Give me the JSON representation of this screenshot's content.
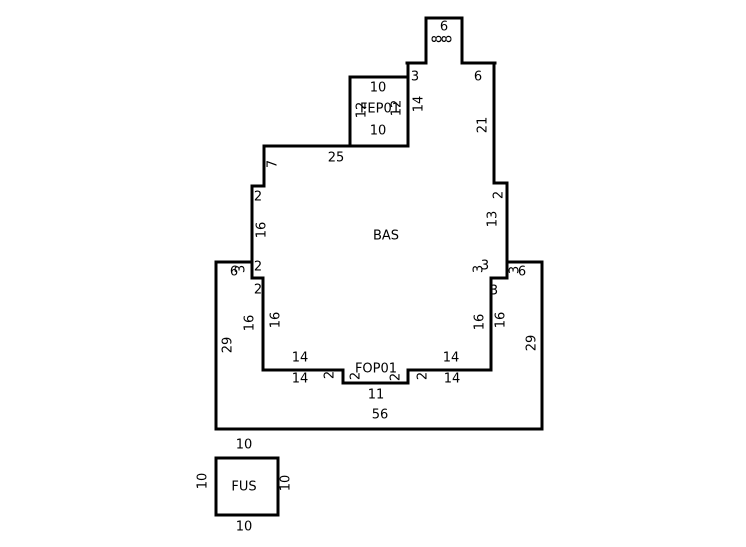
{
  "sketch": {
    "canvas": {
      "width": 746,
      "height": 547,
      "background": "#ffffff",
      "line_color": "#000000"
    },
    "areas": [
      {
        "name": "BAS"
      },
      {
        "name": "FEP01"
      },
      {
        "name": "FOP01"
      },
      {
        "name": "FUS"
      }
    ],
    "outline": {
      "stroke_width": 3,
      "paths": [
        {
          "name": "top-bump",
          "closed": false,
          "points": [
            [
              407,
              63
            ],
            [
              426,
              63
            ],
            [
              426,
              18
            ],
            [
              462,
              18
            ],
            [
              462,
              63
            ],
            [
              495,
              63
            ]
          ]
        },
        {
          "name": "right-upper-wall",
          "closed": false,
          "points": [
            [
              494,
              63
            ],
            [
              494,
              183
            ],
            [
              507,
              183
            ],
            [
              507,
              278
            ],
            [
              491,
              278
            ],
            [
              491,
              370
            ]
          ]
        },
        {
          "name": "bas-bottom-with-porch-notch",
          "closed": false,
          "points": [
            [
              491,
              370
            ],
            [
              408,
              370
            ],
            [
              408,
              383
            ],
            [
              343,
              383
            ],
            [
              343,
              370
            ],
            [
              263,
              370
            ]
          ]
        },
        {
          "name": "left-wall",
          "closed": false,
          "points": [
            [
              263,
              370
            ],
            [
              263,
              278
            ],
            [
              252,
              278
            ],
            [
              252,
              186
            ],
            [
              264,
              186
            ],
            [
              264,
              146
            ]
          ]
        },
        {
          "name": "bas-top-edge",
          "closed": false,
          "points": [
            [
              264,
              146
            ],
            [
              408,
              146
            ]
          ]
        },
        {
          "name": "fep-right-wall",
          "closed": false,
          "points": [
            [
              408,
              63
            ],
            [
              408,
              146
            ]
          ]
        },
        {
          "name": "fep-box",
          "closed": false,
          "points": [
            [
              408,
              77
            ],
            [
              350,
              77
            ],
            [
              350,
              146
            ]
          ]
        },
        {
          "name": "lower-section-left",
          "closed": false,
          "points": [
            [
              252,
              262
            ],
            [
              216,
              262
            ],
            [
              216,
              429
            ]
          ]
        },
        {
          "name": "lower-section-bottom-right",
          "closed": false,
          "points": [
            [
              216,
              429
            ],
            [
              542,
              429
            ],
            [
              542,
              262
            ],
            [
              507,
              262
            ]
          ]
        },
        {
          "name": "fus-box",
          "closed": true,
          "points": [
            [
              216,
              458
            ],
            [
              278,
              458
            ],
            [
              278,
              515
            ],
            [
              216,
              515
            ]
          ]
        }
      ]
    },
    "labels": {
      "font_size": 13,
      "items": [
        {
          "text": "6",
          "x": 444,
          "y": 27,
          "rot": 0,
          "kind": "dimension"
        },
        {
          "text": "8",
          "x": 438,
          "y": 39,
          "rot": -90,
          "kind": "dimension"
        },
        {
          "text": "8",
          "x": 448,
          "y": 39,
          "rot": -90,
          "kind": "dimension"
        },
        {
          "text": "3",
          "x": 415,
          "y": 77,
          "rot": 0,
          "kind": "dimension"
        },
        {
          "text": "6",
          "x": 478,
          "y": 77,
          "rot": 0,
          "kind": "dimension"
        },
        {
          "text": "10",
          "x": 378,
          "y": 88,
          "rot": 0,
          "kind": "dimension"
        },
        {
          "text": "12",
          "x": 362,
          "y": 110,
          "rot": -90,
          "kind": "dimension"
        },
        {
          "text": "FEP01",
          "x": 380,
          "y": 109,
          "rot": 0,
          "kind": "area"
        },
        {
          "text": "12",
          "x": 397,
          "y": 108,
          "rot": -90,
          "kind": "dimension"
        },
        {
          "text": "10",
          "x": 378,
          "y": 131,
          "rot": 0,
          "kind": "dimension"
        },
        {
          "text": "14",
          "x": 419,
          "y": 104,
          "rot": -90,
          "kind": "dimension"
        },
        {
          "text": "21",
          "x": 483,
          "y": 125,
          "rot": -90,
          "kind": "dimension"
        },
        {
          "text": "25",
          "x": 336,
          "y": 158,
          "rot": 0,
          "kind": "dimension"
        },
        {
          "text": "7",
          "x": 273,
          "y": 164,
          "rot": -90,
          "kind": "dimension"
        },
        {
          "text": "2",
          "x": 258,
          "y": 197,
          "rot": 0,
          "kind": "dimension"
        },
        {
          "text": "2",
          "x": 499,
          "y": 195,
          "rot": -90,
          "kind": "dimension"
        },
        {
          "text": "13",
          "x": 493,
          "y": 219,
          "rot": -90,
          "kind": "dimension"
        },
        {
          "text": "16",
          "x": 262,
          "y": 230,
          "rot": -90,
          "kind": "dimension"
        },
        {
          "text": "BAS",
          "x": 386,
          "y": 236,
          "rot": 0,
          "kind": "area"
        },
        {
          "text": "2",
          "x": 258,
          "y": 267,
          "rot": 0,
          "kind": "dimension"
        },
        {
          "text": "6",
          "x": 234,
          "y": 272,
          "rot": 0,
          "kind": "dimension"
        },
        {
          "text": "3",
          "x": 241,
          "y": 269,
          "rot": -90,
          "kind": "dimension"
        },
        {
          "text": "3",
          "x": 479,
          "y": 269,
          "rot": -90,
          "kind": "dimension"
        },
        {
          "text": "3",
          "x": 485,
          "y": 266,
          "rot": 0,
          "kind": "dimension"
        },
        {
          "text": "3",
          "x": 515,
          "y": 270,
          "rot": -90,
          "kind": "dimension"
        },
        {
          "text": "6",
          "x": 522,
          "y": 272,
          "rot": 0,
          "kind": "dimension"
        },
        {
          "text": "2",
          "x": 258,
          "y": 290,
          "rot": 0,
          "kind": "dimension"
        },
        {
          "text": "3",
          "x": 494,
          "y": 291,
          "rot": 0,
          "kind": "dimension"
        },
        {
          "text": "16",
          "x": 250,
          "y": 323,
          "rot": -90,
          "kind": "dimension"
        },
        {
          "text": "16",
          "x": 276,
          "y": 320,
          "rot": -90,
          "kind": "dimension"
        },
        {
          "text": "16",
          "x": 480,
          "y": 322,
          "rot": -90,
          "kind": "dimension"
        },
        {
          "text": "16",
          "x": 501,
          "y": 320,
          "rot": -90,
          "kind": "dimension"
        },
        {
          "text": "29",
          "x": 228,
          "y": 345,
          "rot": -90,
          "kind": "dimension"
        },
        {
          "text": "29",
          "x": 532,
          "y": 343,
          "rot": -90,
          "kind": "dimension"
        },
        {
          "text": "14",
          "x": 300,
          "y": 358,
          "rot": 0,
          "kind": "dimension"
        },
        {
          "text": "14",
          "x": 451,
          "y": 358,
          "rot": 0,
          "kind": "dimension"
        },
        {
          "text": "FOP01",
          "x": 376,
          "y": 369,
          "rot": 0,
          "kind": "area"
        },
        {
          "text": "2",
          "x": 330,
          "y": 375,
          "rot": -90,
          "kind": "dimension"
        },
        {
          "text": "2",
          "x": 356,
          "y": 376,
          "rot": -90,
          "kind": "dimension"
        },
        {
          "text": "2",
          "x": 396,
          "y": 377,
          "rot": -90,
          "kind": "dimension"
        },
        {
          "text": "2",
          "x": 423,
          "y": 376,
          "rot": -90,
          "kind": "dimension"
        },
        {
          "text": "14",
          "x": 300,
          "y": 379,
          "rot": 0,
          "kind": "dimension"
        },
        {
          "text": "14",
          "x": 452,
          "y": 379,
          "rot": 0,
          "kind": "dimension"
        },
        {
          "text": "11",
          "x": 376,
          "y": 395,
          "rot": 0,
          "kind": "dimension"
        },
        {
          "text": "56",
          "x": 380,
          "y": 415,
          "rot": 0,
          "kind": "dimension"
        },
        {
          "text": "10",
          "x": 244,
          "y": 445,
          "rot": 0,
          "kind": "dimension"
        },
        {
          "text": "10",
          "x": 203,
          "y": 481,
          "rot": -90,
          "kind": "dimension"
        },
        {
          "text": "FUS",
          "x": 244,
          "y": 487,
          "rot": 0,
          "kind": "area"
        },
        {
          "text": "10",
          "x": 286,
          "y": 483,
          "rot": -90,
          "kind": "dimension"
        },
        {
          "text": "10",
          "x": 244,
          "y": 527,
          "rot": 0,
          "kind": "dimension"
        }
      ]
    }
  }
}
